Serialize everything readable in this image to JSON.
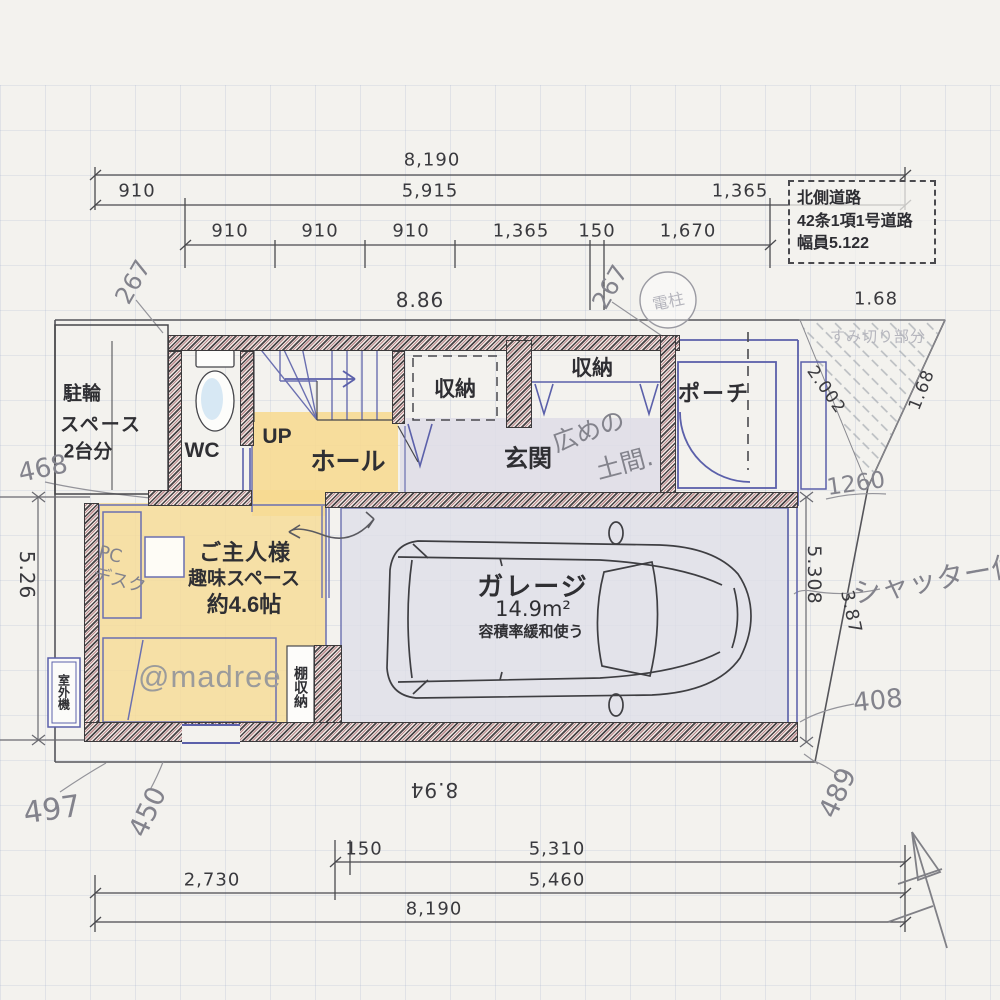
{
  "road_box": {
    "line1": "北側道路",
    "line2": "42条1項1号道路",
    "line3": "幅員5.122"
  },
  "top_dims": {
    "total": "8,190",
    "seg_left": "910",
    "seg_mid": "5,915",
    "seg_right": "1,365",
    "sub": [
      "910",
      "910",
      "910",
      "1,365",
      "150",
      "1,670"
    ],
    "width_m": "8.86",
    "corner_top": "1.68"
  },
  "side_dims": {
    "left_v": "5.26",
    "right_v": "5.308",
    "corner_left": "2.002",
    "corner_right": "1.68",
    "slant": "3.87"
  },
  "bottom_dims": {
    "width_m": "8.94",
    "s150": "150",
    "s5310": "5,310",
    "s2730": "2,730",
    "s5460": "5,460",
    "total": "8,190"
  },
  "notes": {
    "pole": "電柱",
    "corner_cut": "すみ切り部分",
    "d267_left": "267",
    "d267_right": "267",
    "a468": "468",
    "a1260": "1260",
    "a408": "408",
    "a497": "497",
    "a450": "450",
    "a489": "489",
    "shutter": "シャッター付",
    "doma1": "広めの",
    "doma2": "土間.",
    "pc1": "PC",
    "pc2": "デスク"
  },
  "rooms": {
    "bike1": "駐輪",
    "bike2": "スペース",
    "bike3": "2台分",
    "wc": "WC",
    "up": "UP",
    "hall": "ホール",
    "storage1": "収納",
    "storage2": "収納",
    "entrance": "玄関",
    "porch": "ポーチ",
    "hobby1": "ご主人様",
    "hobby2": "趣味スペース",
    "hobby3": "約4.6帖",
    "garage": "ガレージ",
    "garage_area": "14.9m²",
    "garage_note": "容積率緩和使う",
    "shelf": "棚収納",
    "outdoor_unit": "室外機"
  },
  "watermark": "@madree"
}
